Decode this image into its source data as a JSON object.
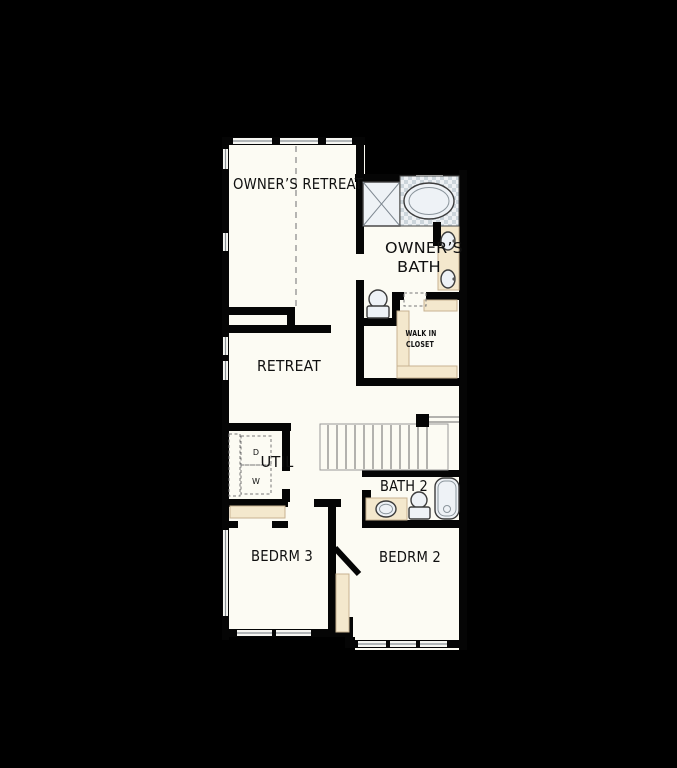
{
  "title": "Second Floor Plan",
  "colors": {
    "background": "#000000",
    "wall": "#050505",
    "floor": "#fcfbf3",
    "casework": "#f4e8cd",
    "fixture": "#eef2f6",
    "tile_dark": "#ccd5db",
    "tile_light": "#eef1f4"
  },
  "rooms": {
    "owners_retreat": {
      "label": "OWNER’S RETREAT"
    },
    "owners_bath": {
      "label_line1": "OWNER’S",
      "label_line2": "BATH"
    },
    "walk_in_closet": {
      "label_line1": "WALK IN",
      "label_line2": "CLOSET"
    },
    "retreat": {
      "label": "RETREAT"
    },
    "util": {
      "label": "UTIL"
    },
    "bath_2": {
      "label": "BATH 2"
    },
    "bedroom_3": {
      "label": "BEDRM 3"
    },
    "bedroom_2": {
      "label": "BEDRM 2"
    }
  },
  "appliances": {
    "dryer": "D",
    "washer": "W"
  }
}
